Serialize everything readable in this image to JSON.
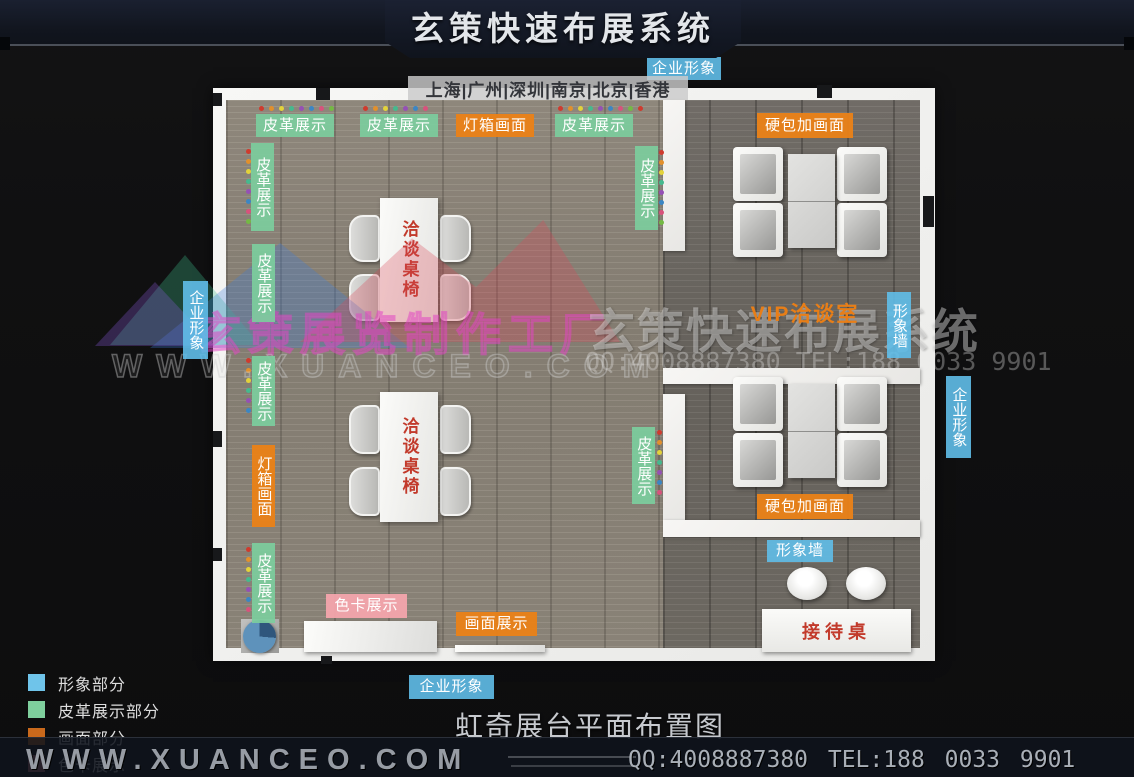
{
  "header": {
    "title": "玄策快速布展系统",
    "cities": "上海|广州|深圳|南京|北京|香港"
  },
  "plan": {
    "table_label": "洽谈桌椅",
    "reception_label": "接待桌",
    "labels": [
      {
        "name": "label-corp-image-top",
        "text": "企业形象",
        "style": "blue",
        "orient": "h",
        "x": 647,
        "y": 57,
        "w": 74,
        "h": 23
      },
      {
        "name": "label-leather-top-1",
        "text": "皮革展示",
        "style": "green",
        "orient": "h",
        "x": 256,
        "y": 114,
        "w": 78,
        "h": 23
      },
      {
        "name": "label-leather-top-2",
        "text": "皮革展示",
        "style": "green",
        "orient": "h",
        "x": 360,
        "y": 114,
        "w": 78,
        "h": 23
      },
      {
        "name": "label-lightbox-top",
        "text": "灯箱画面",
        "style": "orange",
        "orient": "h",
        "x": 456,
        "y": 114,
        "w": 78,
        "h": 23
      },
      {
        "name": "label-leather-top-3",
        "text": "皮革展示",
        "style": "green",
        "orient": "h",
        "x": 555,
        "y": 114,
        "w": 78,
        "h": 23
      },
      {
        "name": "label-hardpack-top",
        "text": "硬包加画面",
        "style": "orange",
        "orient": "h",
        "x": 757,
        "y": 113,
        "w": 96,
        "h": 25
      },
      {
        "name": "label-leather-left-1",
        "text": "皮革展示",
        "style": "green",
        "orient": "v",
        "x": 251,
        "y": 143,
        "w": 23,
        "h": 88
      },
      {
        "name": "label-leather-left-2",
        "text": "皮革展示",
        "style": "green",
        "orient": "v",
        "x": 252,
        "y": 244,
        "w": 23,
        "h": 78
      },
      {
        "name": "label-leather-left-3",
        "text": "皮革展示",
        "style": "green",
        "orient": "v",
        "x": 252,
        "y": 356,
        "w": 23,
        "h": 70
      },
      {
        "name": "label-lightbox-left",
        "text": "灯箱画面",
        "style": "orange",
        "orient": "v",
        "x": 252,
        "y": 445,
        "w": 23,
        "h": 82
      },
      {
        "name": "label-leather-left-4",
        "text": "皮革展示",
        "style": "green",
        "orient": "v",
        "x": 252,
        "y": 543,
        "w": 23,
        "h": 80
      },
      {
        "name": "label-corp-image-left",
        "text": "企业形象",
        "style": "blue",
        "orient": "v",
        "x": 183,
        "y": 281,
        "w": 25,
        "h": 78
      },
      {
        "name": "label-leather-mid-1",
        "text": "皮革展示",
        "style": "green",
        "orient": "v",
        "x": 635,
        "y": 146,
        "w": 23,
        "h": 84
      },
      {
        "name": "label-leather-mid-2",
        "text": "皮革展示",
        "style": "green",
        "orient": "v",
        "x": 632,
        "y": 427,
        "w": 23,
        "h": 77
      },
      {
        "name": "label-vip-room",
        "text": "VIP洽谈室",
        "style": "text-orange",
        "orient": "h",
        "x": 750,
        "y": 302,
        "w": 110,
        "h": 26
      },
      {
        "name": "label-image-wall-vertical",
        "text": "形象墙",
        "style": "blue",
        "orient": "v",
        "x": 887,
        "y": 292,
        "w": 24,
        "h": 66
      },
      {
        "name": "label-corp-image-right",
        "text": "企业形象",
        "style": "blue",
        "orient": "v",
        "x": 946,
        "y": 376,
        "w": 25,
        "h": 82
      },
      {
        "name": "label-hardpack-bottom",
        "text": "硬包加画面",
        "style": "orange",
        "orient": "h",
        "x": 757,
        "y": 494,
        "w": 96,
        "h": 25
      },
      {
        "name": "label-image-wall-horizontal",
        "text": "形象墙",
        "style": "blue",
        "orient": "h",
        "x": 767,
        "y": 540,
        "w": 66,
        "h": 22
      },
      {
        "name": "label-colorcard-display",
        "text": "色卡展示",
        "style": "pink",
        "orient": "h",
        "x": 326,
        "y": 594,
        "w": 81,
        "h": 24
      },
      {
        "name": "label-picture-display",
        "text": "画面展示",
        "style": "orange",
        "orient": "h",
        "x": 456,
        "y": 612,
        "w": 81,
        "h": 24
      },
      {
        "name": "label-corp-image-bottom",
        "text": "企业形象",
        "style": "blue",
        "orient": "h",
        "x": 409,
        "y": 675,
        "w": 85,
        "h": 24
      }
    ],
    "dot_palette": [
      "#cf3b2e",
      "#e2902c",
      "#e3d23a",
      "#45b98e",
      "#9550b5",
      "#3b86c4",
      "#d8527c",
      "#74b944"
    ],
    "dot_groups": [
      {
        "x": 259,
        "y": 106,
        "dir": "h",
        "count": 8
      },
      {
        "x": 363,
        "y": 106,
        "dir": "h",
        "count": 7
      },
      {
        "x": 558,
        "y": 106,
        "dir": "h",
        "count": 9
      },
      {
        "x": 246,
        "y": 149,
        "dir": "v",
        "count": 8
      },
      {
        "x": 246,
        "y": 358,
        "dir": "v",
        "count": 6
      },
      {
        "x": 246,
        "y": 547,
        "dir": "v",
        "count": 7
      },
      {
        "x": 659,
        "y": 150,
        "dir": "v",
        "count": 8
      },
      {
        "x": 657,
        "y": 430,
        "dir": "v",
        "count": 7
      }
    ]
  },
  "watermarks": {
    "logo_text": "玄策展览制作工厂",
    "logo_site": "WWW.XUANCEO.COM",
    "right_title": "玄策快速布展系统",
    "right_contact": "QQ:4008887380 TEL:188 0033 9901"
  },
  "legend": {
    "items": [
      {
        "label": "形象部分",
        "color": "#6fc4ea"
      },
      {
        "label": "皮革展示部分",
        "color": "#7fcf9d"
      },
      {
        "label": "画面部分",
        "color": "#c9691c"
      },
      {
        "label": "色卡展示",
        "color": "#c9777f"
      }
    ]
  },
  "bottom_title": "虹奇展台平面布置图",
  "footer": {
    "site": "WWW.XUANCEO.COM",
    "contact": "QQ:4008887380 TEL:188 0033 9901"
  }
}
